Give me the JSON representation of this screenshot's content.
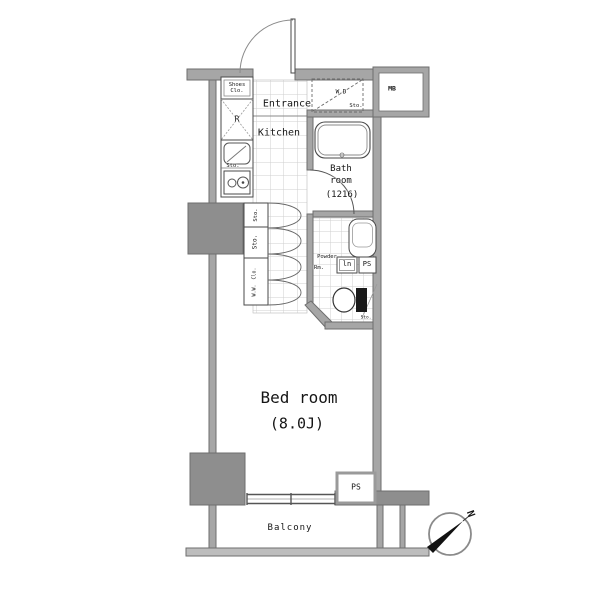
{
  "colors": {
    "wall_fill": "#a6a6a6",
    "wall_edge": "#6e6e6e",
    "column_fill": "#8e8e8e",
    "fixture_line": "#4a4a4a",
    "tile_line": "#cfcfcf",
    "text": "#151515",
    "compass_arrow": "#111111"
  },
  "rooms": {
    "entrance": "Entrance",
    "kitchen": "Kitchen",
    "bath_line1": "Bath",
    "bath_line2": "room",
    "bath_line3": "(1216)",
    "powder_line1": "Powder",
    "powder_line2": "Rm.",
    "bedroom": "Bed room",
    "bedroom_size": "(8.0J)",
    "balcony": "Balcony"
  },
  "fixtures": {
    "shoes_line1": "Shoes",
    "shoes_line2": "Clo.",
    "wd_line1": "W.D",
    "wd_line2": "Sto.",
    "meter_box": "MB",
    "refrigerator": "R",
    "sink_storage": "Sto.",
    "storage_1": "Sto.",
    "storage_2": "Sto.",
    "closet_line1": "W.W.",
    "closet_line2": "Clo.",
    "linen": "ln",
    "pipe_space_powder": "PS",
    "pipe_space_bedroom": "PS",
    "toilet_storage": "Sto."
  },
  "compass": {
    "north": "N"
  }
}
